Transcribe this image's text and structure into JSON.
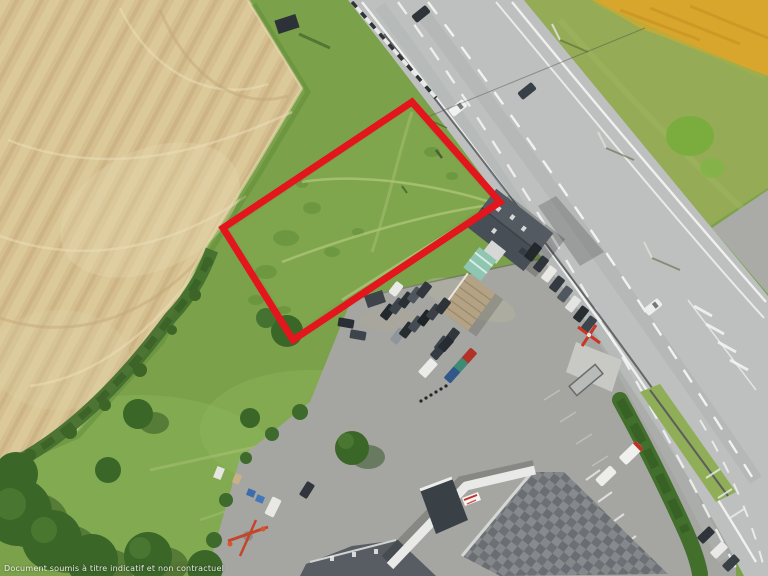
{
  "photo": {
    "watermark_text": "Document soumis à titre indicatif et non contractuel",
    "parcel_outline_color": "#e3151d",
    "road_marking_color": "#f4f5f3",
    "wheat_field_color": "#d5bf90",
    "meadow_color": "#7ba24a",
    "yellow_field_color": "#d8a52d"
  }
}
